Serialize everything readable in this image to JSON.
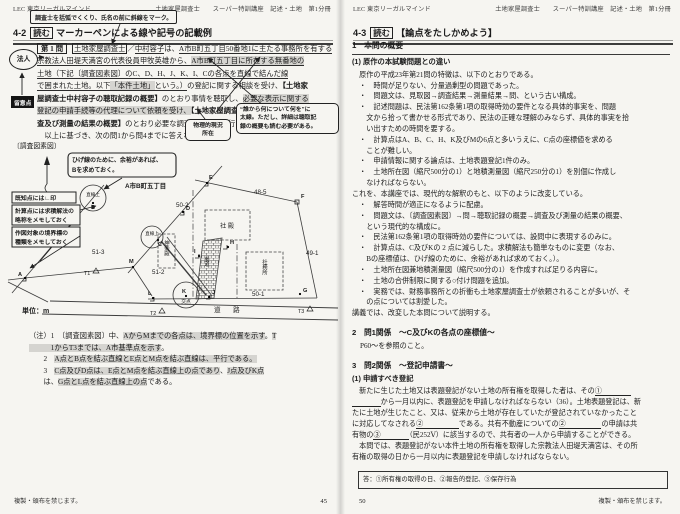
{
  "page_left": {
    "header_brand": "LEC 東京リーガルマインド",
    "header_course": "土地家屋調査士　　スーパー特訓講座　記述・土地　第1分冊",
    "callout_top": "調査士を括弧でくくり、氏名の前に斜線をマーク。",
    "title_num": "4-2",
    "title_tag": "読む",
    "title_rest": "マーカーペンによる線や記号の記載例",
    "margin_legal": "法人",
    "margin_note": "留意点",
    "callout_phys1": "物理的現況",
    "callout_phys2": "所在",
    "callout_bold1": "“誰から何について何を”に",
    "callout_bold2": "太線。ただし、詳細は聴取記",
    "callout_bold3": "録の概要も読む必要がある。",
    "problem_lines": [
      [
        {
          "t": "第 1 問",
          "m": "qbox"
        },
        {
          "t": "土地家屋調査士",
          "m": "box"
        },
        {
          "t": "／"
        },
        {
          "t": "中村容子",
          "m": "ul"
        },
        {
          "t": "は、"
        },
        {
          "t": "A市B町五丁目50番地1に主たる事務所を有する",
          "m": "ul"
        }
      ],
      [
        {
          "t": "宗教法人田堤天満宮の代表役員甲牧英雄から、",
          "m": "ul"
        },
        {
          "t": "A市B町五丁目に所在する無番地の",
          "m": "ul hl"
        }
      ],
      [
        {
          "t": "土地（下記〔調査図素図〕のC、D、H、J、K、I、Cの各点を直線で結んだ線",
          "m": "ul"
        }
      ],
      [
        {
          "t": "で囲まれた土地。以下",
          "m": "ul"
        },
        {
          "t": "「本件土地」",
          "m": "ul hl"
        },
        {
          "t": "という。）",
          "m": "ul"
        },
        {
          "t": "の登記に関する相談を受け、"
        },
        {
          "t": "【土地家",
          "m": "b"
        }
      ],
      [
        {
          "t": "屋調査士中村容子の聴取記録の概要】",
          "m": "b"
        },
        {
          "t": "のとおり事情を聴取し、"
        },
        {
          "t": "必要な表示に関する",
          "m": "hl"
        }
      ],
      [
        {
          "t": "登記の申請手続等の代理について依頼を受け、",
          "m": "hl"
        },
        {
          "t": "【土地家屋調査士中村容子による調",
          "m": "b"
        }
      ],
      [
        {
          "t": "査及び測量の結果の概要】",
          "m": "b"
        },
        {
          "t": "のとおり必要な調査及び測量を行った。"
        }
      ],
      [
        {
          "t": "　以上に基づき、次の問1から問4までに答えなさい。"
        }
      ]
    ],
    "sketch": {
      "label": "〔調査図素図〕",
      "callout_b1": "ひげ線のために、余裕があれば、",
      "callout_b2": "Bを求めておく。",
      "tip1": "既知点には∟印",
      "tip2a": "計算点には求積解法の",
      "tip2b": "略称をメモしておく",
      "tip3a": "作図対象の境界標の",
      "tip3b": "種類をメモしておく",
      "area": "A市B町五丁目",
      "parcels": {
        "p50_2": "50-2",
        "p48_5": "48-5",
        "p49_1": "49-1",
        "p51_3": "51-3",
        "p51_2": "51-2",
        "p50_1": "50-1"
      },
      "buildings": {
        "shaden": "社 殿",
        "kagura": "神楽殿",
        "shamusho": "社務所",
        "sando": "参道"
      },
      "road": "道　路",
      "unit": "単位：m",
      "memo_line": "直線上",
      "memo_cross": "交点",
      "points": {
        "a": "A",
        "b": "B",
        "c": "C",
        "d": "D",
        "e": "E",
        "f": "F",
        "g": "G",
        "h": "H",
        "i": "I",
        "j": "J",
        "k": "K",
        "l": "L",
        "m": "M",
        "t1": "T1",
        "t2": "T2",
        "t3": "T3"
      }
    },
    "notes": [
      [
        {
          "t": "（注）1　〔調査図素図〕中、"
        },
        {
          "t": "AからMまでの各点は、境界標の位置を示す",
          "m": "hl"
        },
        {
          "t": "。"
        },
        {
          "t": "T",
          "m": "hl"
        }
      ],
      [
        {
          "t": "　　　1からT3までは、A市基準点を示す",
          "m": "hl"
        },
        {
          "t": "。"
        }
      ],
      [
        {
          "t": "　　2　"
        },
        {
          "t": "A点とB点を結ぶ直線とE点とM点を結ぶ直線は、平行である。",
          "m": "hl"
        }
      ],
      [
        {
          "t": "　　3　"
        },
        {
          "t": "C点及びD点は、E点とM点を結ぶ直線上の点であり",
          "m": "hl"
        },
        {
          "t": "、"
        },
        {
          "t": "J点及びK点",
          "m": "hl"
        }
      ],
      [
        {
          "t": "　　は、"
        },
        {
          "t": "G点とL点を結ぶ直線上の点",
          "m": "hl"
        },
        {
          "t": "である。"
        }
      ]
    ],
    "footer": "複製・頒布を禁じます。",
    "page_no": "45"
  },
  "page_right": {
    "header_brand": "LEC 東京リーガルマインド",
    "header_course": "土地家屋調査士　　スーパー特訓講座　記述・土地　第1分冊",
    "title_num": "4-3",
    "title_tag": "読む",
    "title_rest": "【論点をたしかめよう】",
    "sec1": "1　本問の概要",
    "sub1": "(1) 原作の本試験問題との違い",
    "body1": [
      [
        {
          "t": "　原作の平成23年第21問の特徴は、以下のとおりである。"
        }
      ],
      [
        {
          "t": "　・　時間が足りない、分量過剰型の問題であった。"
        }
      ],
      [
        {
          "t": "　・　問題文は、見取図→調査結果→測量結果→問、という古い構成。"
        }
      ],
      [
        {
          "t": "　・　記述問題は、民法第162条第1項の取得時効の要件となる具体的事実を、問題"
        }
      ],
      [
        {
          "t": "　　文から拾って書かせる形式であり、民法の正確な理解のみならず、具体的事実を拾"
        }
      ],
      [
        {
          "t": "　　い出すための時間を要する。"
        }
      ],
      [
        {
          "t": "　・　計算点はA、B、C、H、K及びMの6点と多いうえに、C点の座標値を求める"
        }
      ],
      [
        {
          "t": "　　ことが難しい。"
        }
      ],
      [
        {
          "t": "　・　申請情報に関する論点は、土地表題登記1件のみ。"
        }
      ],
      [
        {
          "t": "　・　土地所在図（縮尺500分の1）と地積測量図（縮尺250分の1）を別個に作成し"
        }
      ],
      [
        {
          "t": "　　なければならない。"
        }
      ],
      [
        {
          "t": "これを、本講座では、現代的な解釈のもと、以下のように改変している。"
        }
      ],
      [
        {
          "t": "　・　解答時間が適正になるように配慮。"
        }
      ],
      [
        {
          "t": "　・　問題文は、〔調査図素図〕→問→聴取記録の概要→調査及び測量の結果の概要、"
        }
      ],
      [
        {
          "t": "　　という現代的な構成に。"
        }
      ],
      [
        {
          "t": "　・　民法第162条第1項の取得時効の要件については、設問中に表現するのみに。"
        }
      ],
      [
        {
          "t": "　・　計算点は、C及びKの 2 点に減らした。求積解法も簡単なものに変更（なお、"
        }
      ],
      [
        {
          "t": "　　Bの座標値は、ひげ線のために、余裕があれば求めておく。）。"
        }
      ],
      [
        {
          "t": "　・　土地所在図兼地積測量図（縮尺500分の1）を作成すれば足りる内容に。"
        }
      ],
      [
        {
          "t": "　・　土地の合併制限に関する○付け問題を追加。"
        }
      ],
      [
        {
          "t": "　・　実務では、財務事務所との折衝も土地家屋調査士が依頼されることが多いが、そ"
        }
      ],
      [
        {
          "t": "　　の点については割愛した。"
        }
      ],
      [
        {
          "t": "講義では、改変した本問について説明する。"
        }
      ]
    ],
    "sec2": "2　問1関係　～C及びKの各点の座標値～",
    "sec2_body": "P60～を参照のこと。",
    "sec3": "3　問2関係　～登記申請書～",
    "sub3": "(1) 申請すべき登記",
    "body3": [
      [
        {
          "t": "　新たに生じた土地又は表題登記がない土地の所有権を取得した者は、その"
        },
        {
          "t": "①　　　　",
          "m": "bl"
        }
      ],
      [
        {
          "t": "　　　　",
          "m": "bl"
        },
        {
          "t": "から一月以内に、表題登記を申請しなければならない（36）。土地表題登記は、新"
        }
      ],
      [
        {
          "t": "たに土地が生じたこと、又は、従来から土地が存在していたが登記されていなかったこと"
        }
      ],
      [
        {
          "t": "に対応してなされる"
        },
        {
          "t": "②　　　　　",
          "m": "bl"
        },
        {
          "t": "である。共有不動産についての"
        },
        {
          "t": "②　　　　　",
          "m": "bl"
        },
        {
          "t": "の申請は共"
        }
      ],
      [
        {
          "t": "有物の"
        },
        {
          "t": "③　　　　",
          "m": "bl"
        },
        {
          "t": "（民252Ⅴ）に該当するので、共有者の一人から申請することができる。"
        }
      ],
      [
        {
          "t": "　本問では、表題登記がない本件土地の所有権を取得した宗教法人田堤天満宮は、その所"
        }
      ],
      [
        {
          "t": "有権の取得の日から一月以内に表題登記を申請しなければならない。"
        }
      ]
    ],
    "answer": "答：①所有権の取得の日、②報告的登記、③保存行為",
    "footer": "複製・頒布を禁じます。",
    "page_no": "50"
  }
}
